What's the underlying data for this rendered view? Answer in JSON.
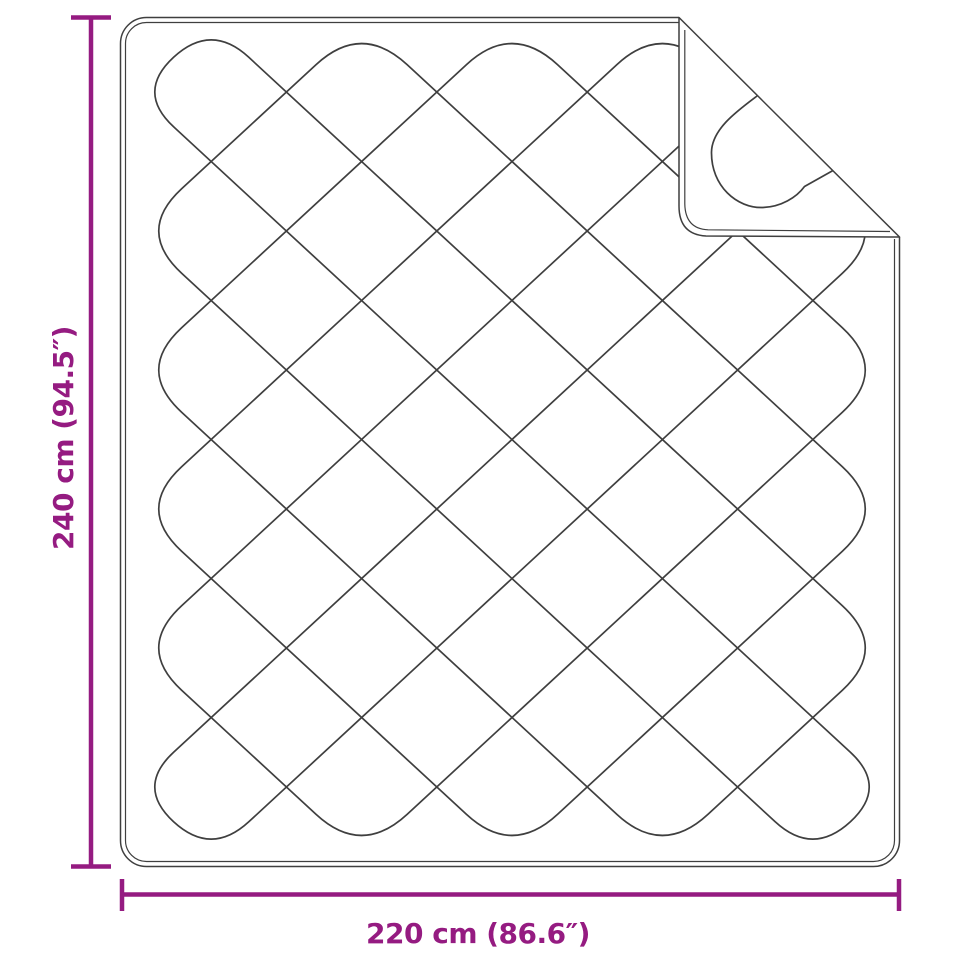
{
  "colors": {
    "accent": "#951B81",
    "line": "#3f3f3f",
    "background": "#ffffff"
  },
  "dimensions": {
    "vertical": {
      "label": "240 cm (94.5″)"
    },
    "horizontal": {
      "label": "220 cm (86.6″)"
    }
  }
}
